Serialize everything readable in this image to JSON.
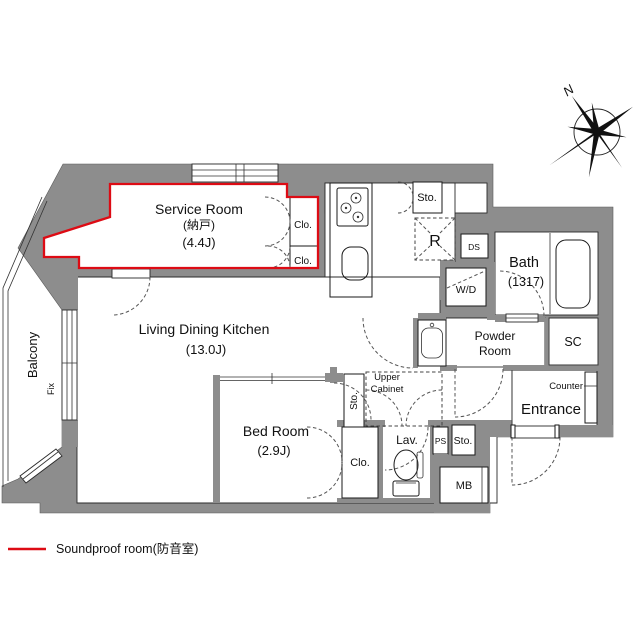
{
  "compass": {
    "north": "N"
  },
  "rooms": {
    "service": {
      "name": "Service Room",
      "sub": "(納戸)",
      "size": "(4.4J)"
    },
    "ldk": {
      "name": "Living Dining Kitchen",
      "size": "(13.0J)"
    },
    "bedroom": {
      "name": "Bed Room",
      "size": "(2.9J)"
    },
    "bath": {
      "name": "Bath",
      "size": "(1317)"
    },
    "powder": {
      "line1": "Powder",
      "line2": "Room"
    },
    "entrance": {
      "name": "Entrance"
    },
    "balcony": {
      "name": "Balcony",
      "fix": "Fix"
    },
    "lav": {
      "name": "Lav."
    }
  },
  "fixtures": {
    "closet_service_1": "Clo.",
    "closet_service_2": "Clo.",
    "closet_bedroom": "Clo.",
    "storage_kitchen": "Sto.",
    "storage_hall": "Sto.",
    "storage_corridor": "Sto.",
    "fridge": "R",
    "duct_space": "DS",
    "washer_dryer": "W/D",
    "shoe_closet": "SC",
    "counter": "Counter",
    "upper_cabinet_line1": "Upper",
    "upper_cabinet_line2": "Cabinet",
    "pipe_space": "PS",
    "meter_box": "MB"
  },
  "legend": {
    "soundproof": "Soundproof room(防音室)"
  },
  "colors": {
    "wall": "#8d8d8d",
    "soundproof_red": "#dd0b14",
    "line": "#1a1a1a",
    "dash": "#555555"
  }
}
